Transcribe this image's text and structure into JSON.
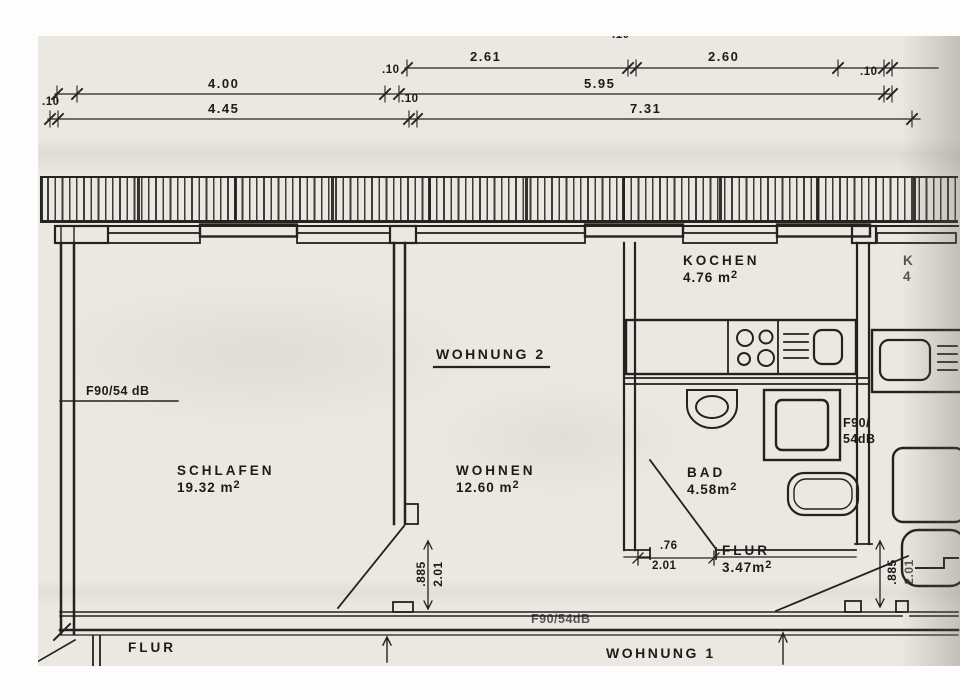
{
  "dims": {
    "tick_small": ".10",
    "row1": {
      "seg1": "2.61",
      "seg2": "2.60"
    },
    "row2": {
      "seg1": "4.00",
      "seg2": "5.95"
    },
    "row3": {
      "seg1": "4.45",
      "seg2": "7.31"
    }
  },
  "rooms": {
    "schlafen": {
      "name": "SCHLAFEN",
      "area": "19.32 m",
      "sup": "2"
    },
    "wohnen": {
      "name": "WOHNEN",
      "area": "12.60 m",
      "sup": "2"
    },
    "kochen": {
      "name": "KOCHEN",
      "area": "4.76 m",
      "sup": "2"
    },
    "bad": {
      "name": "BAD",
      "area": "4.58m",
      "sup": "2"
    },
    "flur": {
      "name": "FLUR",
      "area": "3.47m",
      "sup": "2"
    },
    "flur_unit1": {
      "name": "FLUR"
    }
  },
  "units": {
    "wohnung2": "WOHNUNG 2",
    "wohnung1": "WOHNUNG 1"
  },
  "fire_ratings": {
    "left": "F90/54 dB",
    "bottom": "F90/54dB",
    "right_line1": "F90/",
    "right_line2": "54dB"
  },
  "partial_labels": {
    "kitchen_letter": "K",
    "kitchen_number": "4"
  },
  "door_dims": {
    "schlafen_door": {
      "width": ".885",
      "height": "2.01"
    },
    "bad_door": {
      "width": ".76",
      "height": "2.01"
    },
    "entry_door": {
      "width": ".885",
      "height": "2.01"
    }
  }
}
